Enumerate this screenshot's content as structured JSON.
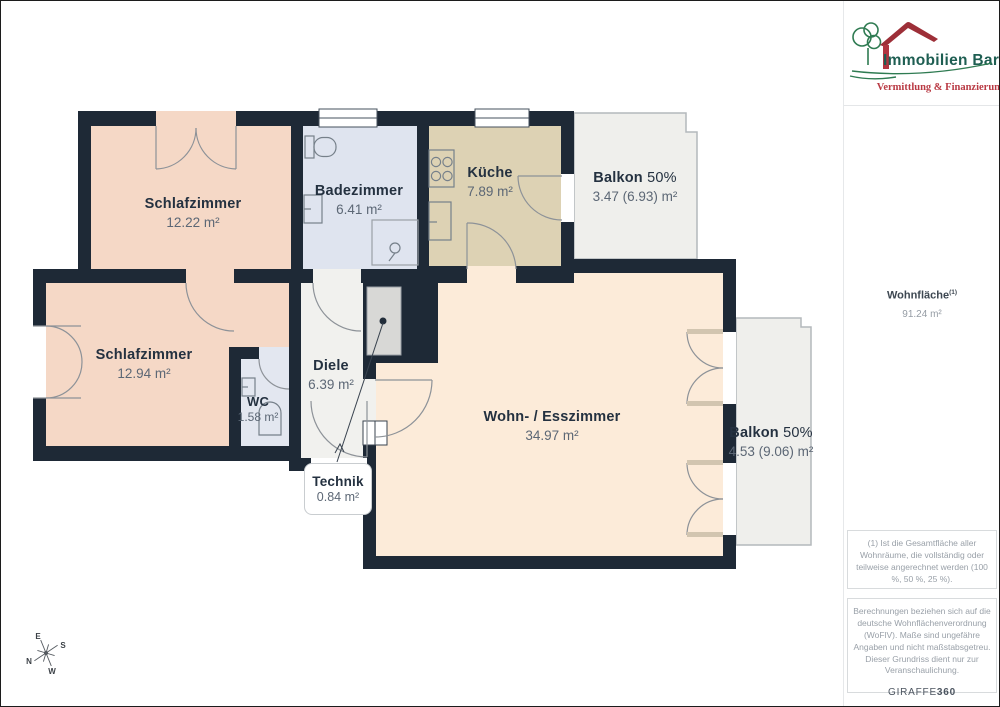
{
  "branding": {
    "company": "Immobilien Bart",
    "tagline": "Vermittlung & Finanzierung"
  },
  "summary": {
    "label": "Wohnfläche",
    "sup": "(1)",
    "value": "91.24 m²"
  },
  "rooms": [
    {
      "id": "schlafzimmer-1",
      "name": "Schlafzimmer",
      "area": "12.22 m²"
    },
    {
      "id": "badezimmer",
      "name": "Badezimmer",
      "area": "6.41 m²"
    },
    {
      "id": "kueche",
      "name": "Küche",
      "area": "7.89 m²"
    },
    {
      "id": "balkon-1",
      "name": "Balkon",
      "share": "50%",
      "area": "3.47 (6.93) m²"
    },
    {
      "id": "schlafzimmer-2",
      "name": "Schlafzimmer",
      "area": "12.94 m²"
    },
    {
      "id": "wc",
      "name": "WC",
      "area": "1.58 m²"
    },
    {
      "id": "diele",
      "name": "Diele",
      "area": "6.39 m²"
    },
    {
      "id": "technik",
      "name": "Technik",
      "area": "0.84 m²"
    },
    {
      "id": "wohn-esszimmer",
      "name": "Wohn- / Esszimmer",
      "area": "34.97 m²"
    },
    {
      "id": "balkon-2",
      "name": "Balkon",
      "share": "50%",
      "area": "4.53 (9.06) m²"
    }
  ],
  "compass": {
    "e": "E",
    "s": "S",
    "n": "N",
    "w": "W"
  },
  "footnotes": {
    "note1": "(1) Ist die Gesamtfläche aller Wohnräume, die vollständig oder teilweise angerechnet werden (100 %, 50 %, 25 %).",
    "note2": "Berechnungen beziehen sich auf die deutsche Wohnflächenverordnung (WoFlV). Maße sind ungefähre Angaben und nicht maßstabsgetreu. Dieser Grundriss dient nur zur Veranschaulichung.",
    "brand_left": "GIRAFFE",
    "brand_right": "360"
  },
  "colors": {
    "wall": "#1e2936",
    "bedroom": "#f5d8c6",
    "living": "#fcebd9",
    "bath": "#dfe4ef",
    "wc": "#e3e7f0",
    "kitchen": "#ddd2b4",
    "hall": "#f1f1ee",
    "balcony": "#efefec",
    "technik_closet": "#d8d8d6",
    "logo_green": "#2f7b52",
    "logo_text_green": "#1e5e52",
    "logo_red": "#b93a44"
  }
}
